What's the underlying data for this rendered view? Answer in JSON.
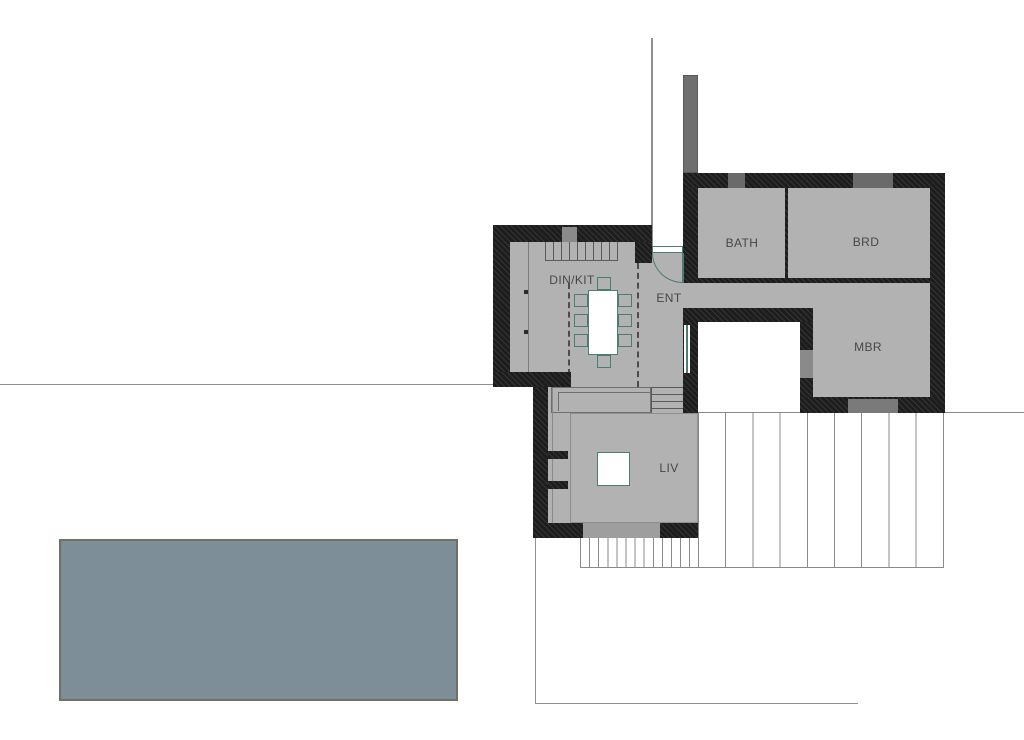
{
  "plan": {
    "type": "architectural-floor-plan",
    "rooms": [
      {
        "id": "bath",
        "label": "BATH"
      },
      {
        "id": "brd",
        "label": "BRD"
      },
      {
        "id": "mbr",
        "label": "MBR"
      },
      {
        "id": "dinkit",
        "label": "DIN/KIT"
      },
      {
        "id": "ent",
        "label": "ENT"
      },
      {
        "id": "liv",
        "label": "LIV"
      }
    ],
    "colors": {
      "wall": "#1d1d1d",
      "floor": "#b2b2b2",
      "accent_teal": "#4d7d72",
      "pool_fill": "#7d8e98",
      "pool_border": "#6e7264",
      "window_marker_dark": "#6a6a6a",
      "window_marker_mid": "#8a8a8a",
      "window_marker_light": "#9e9e9e",
      "boundary_line": "#909090",
      "deck_line": "#8a8a8a",
      "label_text": "#474747"
    }
  }
}
